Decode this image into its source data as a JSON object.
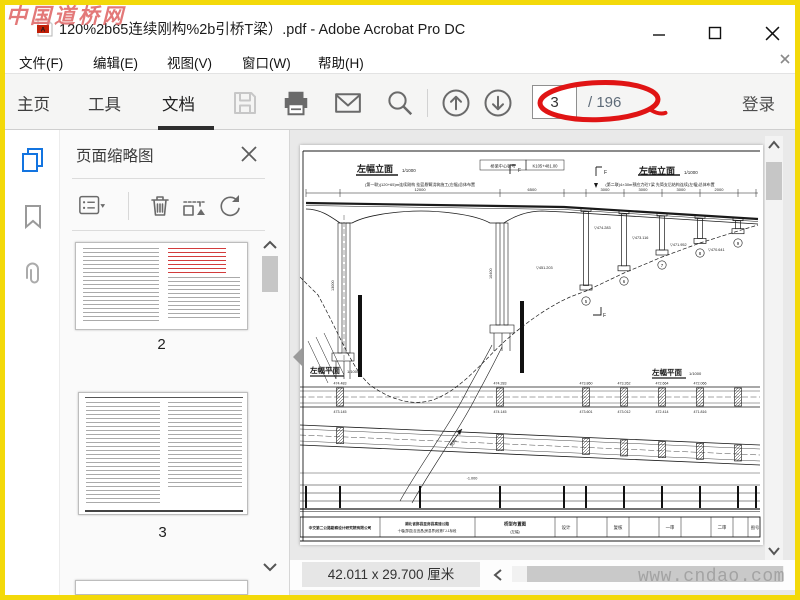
{
  "colors": {
    "frame_yellow": "#f3d90a",
    "annotation_red": "#e01414",
    "accent_blue": "#1374e0",
    "watermark_red": "#e06a6a"
  },
  "window": {
    "title": "120%2b65连续刚构%2b引桥T梁）.pdf - Adobe Acrobat Pro DC",
    "watermark_top": "中国道桥网",
    "watermark_bottom": "www.cndao.com"
  },
  "menu": {
    "items": [
      "文件(F)",
      "编辑(E)",
      "视图(V)",
      "窗口(W)",
      "帮助(H)"
    ]
  },
  "toolbar": {
    "tabs": [
      "主页",
      "工具",
      "文档"
    ],
    "active_tab": "文档",
    "page_current": "3",
    "page_total_label": "/ 196",
    "signin_label": "登录"
  },
  "panel": {
    "title": "页面缩略图",
    "thumbnails": [
      {
        "label": "2"
      },
      {
        "label": "3"
      }
    ]
  },
  "statusbar": {
    "doc_size": "42.011 x 29.700 厘米"
  },
  "drawing": {
    "elev_title_left": "左幅立面",
    "elev_title_right": "左幅立面",
    "elev_scale": "1/1000",
    "center_label": "桥梁中心桩号",
    "center_value": "K105+481.00",
    "note_left": "(第一联)(120+65)m连续刚构 挂篮悬臂浇筑施工(左幅)总体布置",
    "note_right": "(第二联)4×30m预应力砼T梁 先简支后结构连续(左幅)总体布置",
    "dims": [
      "12000",
      "6500",
      "3000",
      "3000",
      "3000",
      "2000"
    ],
    "pier_dims": [
      "13000",
      "10400"
    ],
    "elev_callouts": [
      "▽474.283",
      "▽473.116",
      "▽471.952",
      "▽470.641",
      "▽451.203"
    ],
    "pier_numbers": [
      "5",
      "6",
      "7",
      "8",
      "9"
    ],
    "section_mark": "F",
    "plan_title_left": "左幅平面",
    "plan_title_right": "左幅平面",
    "plan_scale": "1/1000",
    "plan_callouts_top": [
      "474.483",
      "474.283",
      "473.860",
      "473.262",
      "472.664",
      "472.066"
    ],
    "plan_callouts_bottom": [
      "473.145",
      "474.145",
      "473.601",
      "473.012",
      "472.414",
      "471.816"
    ],
    "flow_label": "流向",
    "profile_label": "-1.000",
    "titleblock": {
      "company": "中交第二公路勘察设计研究院有限公司",
      "project_line1": "湖北省郧县至房县高速公路",
      "project_line2": "十堰(郧县)至宜昌(房县界)段第TJ-1标段",
      "sheet_line1": "桥型布置图",
      "sheet_line2": "(左幅)",
      "role_design": "设计",
      "role_check": "复核",
      "role_review1": "一审",
      "role_review2": "二审",
      "sheet_no": "图号"
    }
  }
}
